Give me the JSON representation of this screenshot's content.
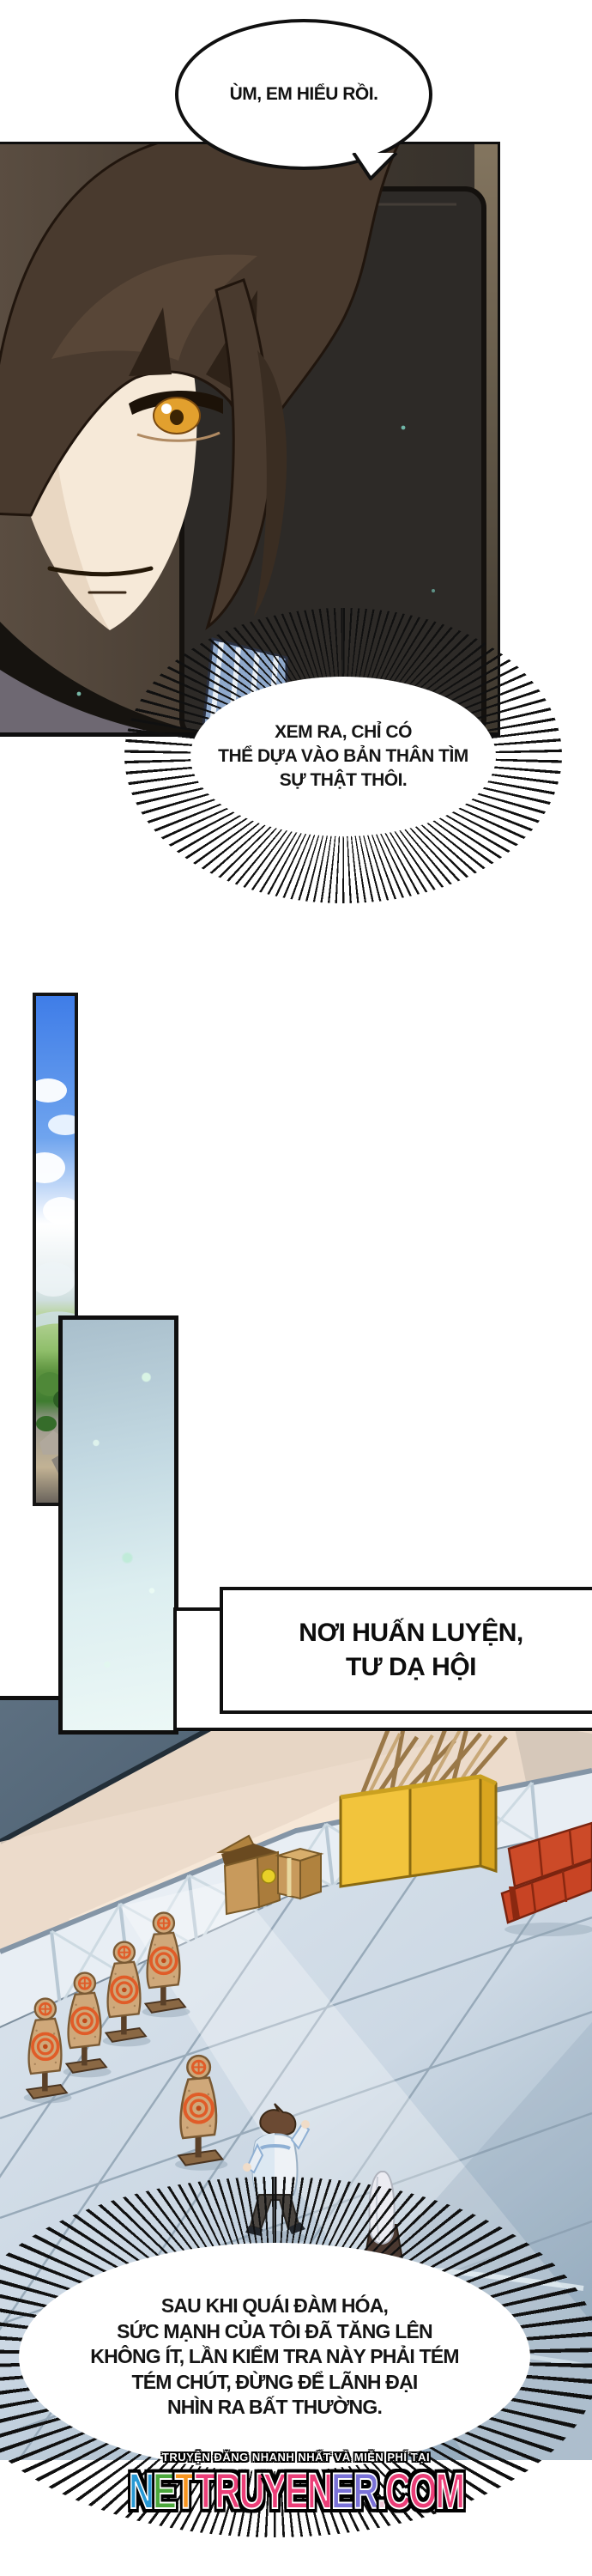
{
  "bubbles": {
    "top": {
      "text": "ÙM, EM HIỂU RỒI."
    },
    "mid": {
      "text": "XEM RA, CHỈ CÓ\nTHỂ DỰA VÀO BẢN THÂN TÌM\nSỰ THẬT THÔI."
    },
    "bottom": {
      "text": "SAU KHI QUÁI ĐÀM HÓA,\nSỨC MẠNH CỦA TÔI ĐÃ TĂNG LÊN\nKHÔNG ÍT, LẦN KIỂM TRA NÀY PHẢI TÉM\nTÉM CHÚT, ĐỪNG ĐỂ LÃNH ĐẠI\nNHÌN RA BẤT THƯỜNG."
    }
  },
  "caption": {
    "text": "NƠI HUẤN LUYỆN,\nTƯ DẠ HỘI"
  },
  "footer": {
    "tagline": "TRUYỆN ĐĂNG NHANH NHẤT VÀ MIỄN PHÍ TẠI",
    "site": "NETTRUYENER.COM",
    "letters": [
      {
        "ch": "N",
        "color": "#2798d4"
      },
      {
        "ch": "E",
        "color": "#4ca83c"
      },
      {
        "ch": "T",
        "color": "#f7941e"
      },
      {
        "ch": "T",
        "color": "#ec3e78"
      },
      {
        "ch": "R",
        "color": "#ec3e78"
      },
      {
        "ch": "U",
        "color": "#ec3e78"
      },
      {
        "ch": "Y",
        "color": "#ec3e78"
      },
      {
        "ch": "E",
        "color": "#ec3e78"
      },
      {
        "ch": "N",
        "color": "#ec3e78"
      },
      {
        "ch": "E",
        "color": "#7a72d8"
      },
      {
        "ch": "R",
        "color": "#7a72d8"
      },
      {
        "ch": ".",
        "color": "#f0c8d8"
      },
      {
        "ch": "C",
        "color": "#ec3e78"
      },
      {
        "ch": "O",
        "color": "#ec3e78"
      },
      {
        "ch": "M",
        "color": "#ec3e78"
      }
    ]
  }
}
